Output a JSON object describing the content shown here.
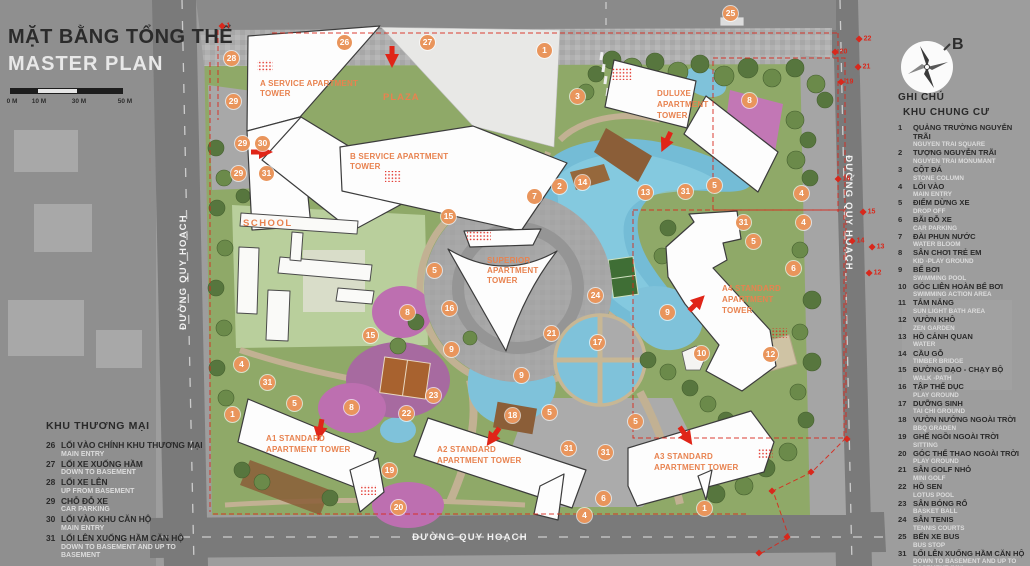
{
  "title_block": {
    "title_vi": "MẶT BẰNG TỔNG THỂ",
    "title_en": "MASTER PLAN",
    "scale_labels": [
      "0 M",
      "10 M",
      "30 M",
      "50 M"
    ]
  },
  "compass": {
    "label": "B"
  },
  "roads": {
    "left": "ĐƯỜNG QUY HOẠCH",
    "right": "ĐƯỜNG QUY HOẠCH",
    "bottom": "ĐƯỜNG QUY HOẠCH"
  },
  "buildings": {
    "plaza": {
      "lines": [
        "PLAZA"
      ]
    },
    "school": {
      "lines": [
        "SCHOOL"
      ]
    },
    "a_service": {
      "lines": [
        "A SERVICE APARTMENT",
        "TOWER"
      ]
    },
    "b_service": {
      "lines": [
        "B SERVICE APARTMENT",
        "TOWER"
      ]
    },
    "superior": {
      "lines": [
        "SUPERIOR",
        "APARTMENT",
        "TOWER"
      ]
    },
    "duluxe": {
      "lines": [
        "DULUXE",
        "APARTMENT",
        "TOWER"
      ]
    },
    "a4": {
      "lines": [
        "A4 STANDARD",
        "APARTMENT",
        "TOWER"
      ]
    },
    "a1": {
      "lines": [
        "A1 STANDARD",
        "APARTMENT TOWER"
      ]
    },
    "a2": {
      "lines": [
        "A2  STANDARD",
        "APARTMENT TOWER"
      ]
    },
    "a3": {
      "lines": [
        "A3 STANDARD",
        "APARTMENT TOWER"
      ]
    }
  },
  "legend_right": {
    "heading": "GHI CHÚ",
    "subheading": "KHU CHUNG CƯ",
    "items": [
      {
        "n": "1",
        "vi": "QUẢNG TRƯỜNG NGUYỄN TRÃI",
        "en": "NGUYEN TRAI SQUARE"
      },
      {
        "n": "2",
        "vi": "TƯỢNG NGUYỄN TRÃI",
        "en": "NGUYEN TRAI MONUMANT"
      },
      {
        "n": "3",
        "vi": "CỘT ĐÁ",
        "en": "STONE COLUMN"
      },
      {
        "n": "4",
        "vi": "LỐI VÀO",
        "en": "MAIN ENTRY"
      },
      {
        "n": "5",
        "vi": "ĐIỂM DỪNG XE",
        "en": "DROP OFF"
      },
      {
        "n": "6",
        "vi": "BÃI ĐỖ XE",
        "en": "CAR PARKING"
      },
      {
        "n": "7",
        "vi": "ĐÀI PHUN NƯỚC",
        "en": "WATER BLOOM"
      },
      {
        "n": "8",
        "vi": "SÂN CHƠI TRẺ EM",
        "en": "KID -PLAY GROUND"
      },
      {
        "n": "9",
        "vi": "BỂ BƠI",
        "en": "SWIMMING POOL"
      },
      {
        "n": "10",
        "vi": "GÓC LIÊN HOÀN BỂ BƠI",
        "en": "SWIMMING ACTION AREA"
      },
      {
        "n": "11",
        "vi": "TẮM NẮNG",
        "en": "SUN LIGHT BATH AREA"
      },
      {
        "n": "12",
        "vi": "VƯỜN KHÔ",
        "en": "ZEN GARDEN"
      },
      {
        "n": "13",
        "vi": "HỒ CẢNH QUAN",
        "en": "WATER"
      },
      {
        "n": "14",
        "vi": "CẦU GỖ",
        "en": "TIMBER BRIDGE"
      },
      {
        "n": "15",
        "vi": "ĐƯỜNG DẠO - CHẠY BỘ",
        "en": "WALK -PATH"
      },
      {
        "n": "16",
        "vi": "TẬP THỂ DỤC",
        "en": "PLAY GROUND"
      },
      {
        "n": "17",
        "vi": "DƯỠNG SINH",
        "en": "TAI CHI GROUND"
      },
      {
        "n": "18",
        "vi": "VƯỜN NƯỚNG NGOÀI TRỜI",
        "en": "BBQ GRADEN"
      },
      {
        "n": "19",
        "vi": "GHẾ NGỒI NGOÀI TRỜI",
        "en": "SITTING"
      },
      {
        "n": "20",
        "vi": "GÓC THỂ THAO NGOÀI TRỜI",
        "en": "PLAY GROUND"
      },
      {
        "n": "21",
        "vi": "SÂN GOLF NHỎ",
        "en": "MINI GOLF"
      },
      {
        "n": "22",
        "vi": "HỒ SEN",
        "en": "LOTUS POOL"
      },
      {
        "n": "23",
        "vi": "SÂN BÓNG RỔ",
        "en": "BASKET BALL"
      },
      {
        "n": "24",
        "vi": "SÂN TENIS",
        "en": "TENNIS COURTS"
      },
      {
        "n": "25",
        "vi": "BẾN XE BUS",
        "en": "BUS STOP"
      },
      {
        "n": "31",
        "vi": "LỐI LÊN XUỐNG HẦM CĂN HỘ",
        "en": "DOWN TO BASEMENT AND UP TO BASEMENT    (MN)"
      }
    ]
  },
  "legend_left": {
    "heading": "KHU THƯƠNG MẠI",
    "items": [
      {
        "n": "26",
        "vi": "LỐI VÀO CHÍNH KHU THƯƠNG MẠI",
        "en": "MAIN ENTRY"
      },
      {
        "n": "27",
        "vi": "LỐI XE XUỐNG HẦM",
        "en": "DOWN TO BASEMENT"
      },
      {
        "n": "28",
        "vi": "LỐI XE LÊN",
        "en": "UP FROM BASEMENT"
      },
      {
        "n": "29",
        "vi": "CHỖ ĐỖ XE",
        "en": "CAR PARKING"
      },
      {
        "n": "30",
        "vi": "LỐI VÀO KHU CĂN HỘ",
        "en": "MAIN ENTRY"
      },
      {
        "n": "31",
        "vi": "LỐI LÊN XUỐNG HẦM CĂN HỘ",
        "en": "DOWN TO BASEMENT AND UP TO BASEMENT"
      }
    ]
  },
  "map": {
    "markers": [
      {
        "n": "28",
        "x": 232,
        "y": 59
      },
      {
        "n": "26",
        "x": 345,
        "y": 43
      },
      {
        "n": "27",
        "x": 428,
        "y": 43
      },
      {
        "n": "1",
        "x": 545,
        "y": 51
      },
      {
        "n": "3",
        "x": 578,
        "y": 97
      },
      {
        "n": "25",
        "x": 731,
        "y": 14
      },
      {
        "n": "29",
        "x": 234,
        "y": 102
      },
      {
        "n": "29",
        "x": 243,
        "y": 144
      },
      {
        "n": "30",
        "x": 263,
        "y": 144
      },
      {
        "n": "29",
        "x": 239,
        "y": 174
      },
      {
        "n": "31",
        "x": 267,
        "y": 174
      },
      {
        "n": "8",
        "x": 750,
        "y": 101
      },
      {
        "n": "7",
        "x": 535,
        "y": 197
      },
      {
        "n": "2",
        "x": 560,
        "y": 187
      },
      {
        "n": "14",
        "x": 583,
        "y": 183
      },
      {
        "n": "13",
        "x": 646,
        "y": 193
      },
      {
        "n": "31",
        "x": 686,
        "y": 192
      },
      {
        "n": "5",
        "x": 715,
        "y": 186
      },
      {
        "n": "4",
        "x": 802,
        "y": 194
      },
      {
        "n": "15",
        "x": 449,
        "y": 217
      },
      {
        "n": "5",
        "x": 435,
        "y": 271
      },
      {
        "n": "16",
        "x": 450,
        "y": 309
      },
      {
        "n": "8",
        "x": 408,
        "y": 313
      },
      {
        "n": "15",
        "x": 371,
        "y": 336
      },
      {
        "n": "9",
        "x": 452,
        "y": 350
      },
      {
        "n": "24",
        "x": 596,
        "y": 296
      },
      {
        "n": "21",
        "x": 552,
        "y": 334
      },
      {
        "n": "17",
        "x": 598,
        "y": 343
      },
      {
        "n": "9",
        "x": 668,
        "y": 313
      },
      {
        "n": "31",
        "x": 744,
        "y": 223
      },
      {
        "n": "4",
        "x": 804,
        "y": 223
      },
      {
        "n": "5",
        "x": 754,
        "y": 242
      },
      {
        "n": "6",
        "x": 794,
        "y": 269
      },
      {
        "n": "10",
        "x": 702,
        "y": 354
      },
      {
        "n": "12",
        "x": 771,
        "y": 355
      },
      {
        "n": "9",
        "x": 522,
        "y": 376
      },
      {
        "n": "18",
        "x": 513,
        "y": 416
      },
      {
        "n": "5",
        "x": 550,
        "y": 413
      },
      {
        "n": "5",
        "x": 636,
        "y": 422
      },
      {
        "n": "31",
        "x": 569,
        "y": 449
      },
      {
        "n": "31",
        "x": 606,
        "y": 453
      },
      {
        "n": "4",
        "x": 242,
        "y": 365
      },
      {
        "n": "31",
        "x": 268,
        "y": 383
      },
      {
        "n": "1",
        "x": 233,
        "y": 415
      },
      {
        "n": "5",
        "x": 295,
        "y": 404
      },
      {
        "n": "8",
        "x": 352,
        "y": 408
      },
      {
        "n": "22",
        "x": 407,
        "y": 414
      },
      {
        "n": "23",
        "x": 434,
        "y": 396
      },
      {
        "n": "19",
        "x": 390,
        "y": 471
      },
      {
        "n": "20",
        "x": 399,
        "y": 508
      },
      {
        "n": "6",
        "x": 604,
        "y": 499
      },
      {
        "n": "4",
        "x": 585,
        "y": 516
      },
      {
        "n": "1",
        "x": 705,
        "y": 509
      }
    ],
    "boundary_points": [
      {
        "n": "1",
        "x": 225,
        "y": 26
      },
      {
        "n": "22",
        "x": 864,
        "y": 39
      },
      {
        "n": "20",
        "x": 840,
        "y": 52
      },
      {
        "n": "21",
        "x": 863,
        "y": 67
      },
      {
        "n": "19",
        "x": 846,
        "y": 82
      },
      {
        "n": "16",
        "x": 843,
        "y": 179
      },
      {
        "n": "15",
        "x": 868,
        "y": 212
      },
      {
        "n": "14",
        "x": 857,
        "y": 241
      },
      {
        "n": "13",
        "x": 877,
        "y": 247
      },
      {
        "n": "12",
        "x": 874,
        "y": 273
      },
      {
        "n": "",
        "x": 848,
        "y": 439
      },
      {
        "n": "",
        "x": 812,
        "y": 472
      },
      {
        "n": "",
        "x": 773,
        "y": 491
      },
      {
        "n": "",
        "x": 788,
        "y": 537
      },
      {
        "n": "",
        "x": 760,
        "y": 553
      }
    ]
  },
  "colors": {
    "marker_orange": "#e9955c",
    "label_orange": "#e8824f",
    "boundary_red": "#d8281c",
    "water_blue": "#74bcd6",
    "site_green": "#8fa968",
    "road_gray": "#7a7a7a",
    "building_white": "#fdfdfd",
    "play_pink": "#bd6fb0"
  }
}
